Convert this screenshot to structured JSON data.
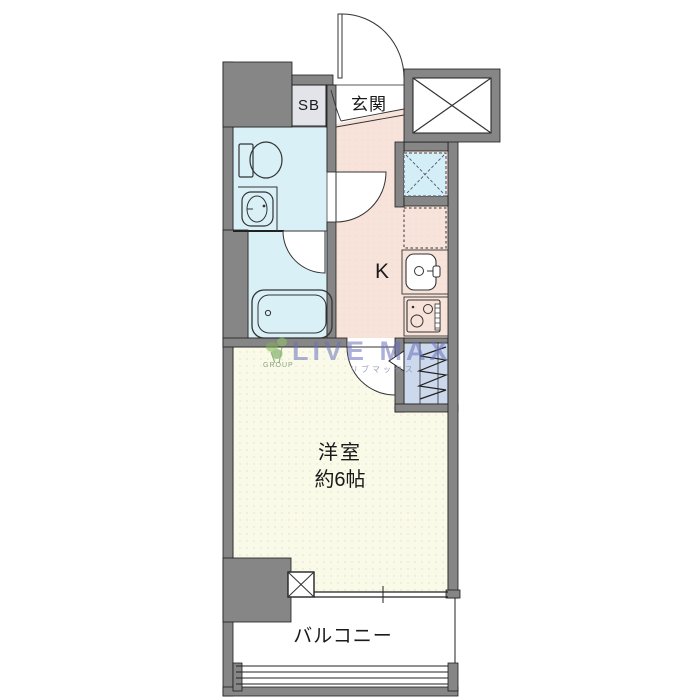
{
  "rooms": {
    "entrance_label": "玄関",
    "shoe_box_label": "SB",
    "kitchen_label": "K",
    "western_room_label": "洋室",
    "western_room_size": "約6帖",
    "balcony_label": "バルコニー"
  },
  "watermark": {
    "brand": "LIVE MAX",
    "brand_katakana": "リブマックス",
    "group": "GROUP"
  },
  "colors": {
    "wall_gray": "#868686",
    "wet_area_blue": "#d9f0f7",
    "hall_floor_pink": "#f8e3da",
    "room_floor_cream": "#fafae8",
    "closet_lavender": "#ccd8eb",
    "line_dark": "#222222",
    "watermark_blue": "#6a71bc",
    "watermark_green": "#7db356"
  },
  "fixtures": [
    "entry-door",
    "shoe-box",
    "elevator-shaft",
    "toilet",
    "wash-basin",
    "bathtub",
    "washing-machine-space",
    "refrigerator-space",
    "kitchen-sink",
    "gas-stove",
    "closet-hanger",
    "pipe-space",
    "balcony-window",
    "balcony-railing"
  ]
}
